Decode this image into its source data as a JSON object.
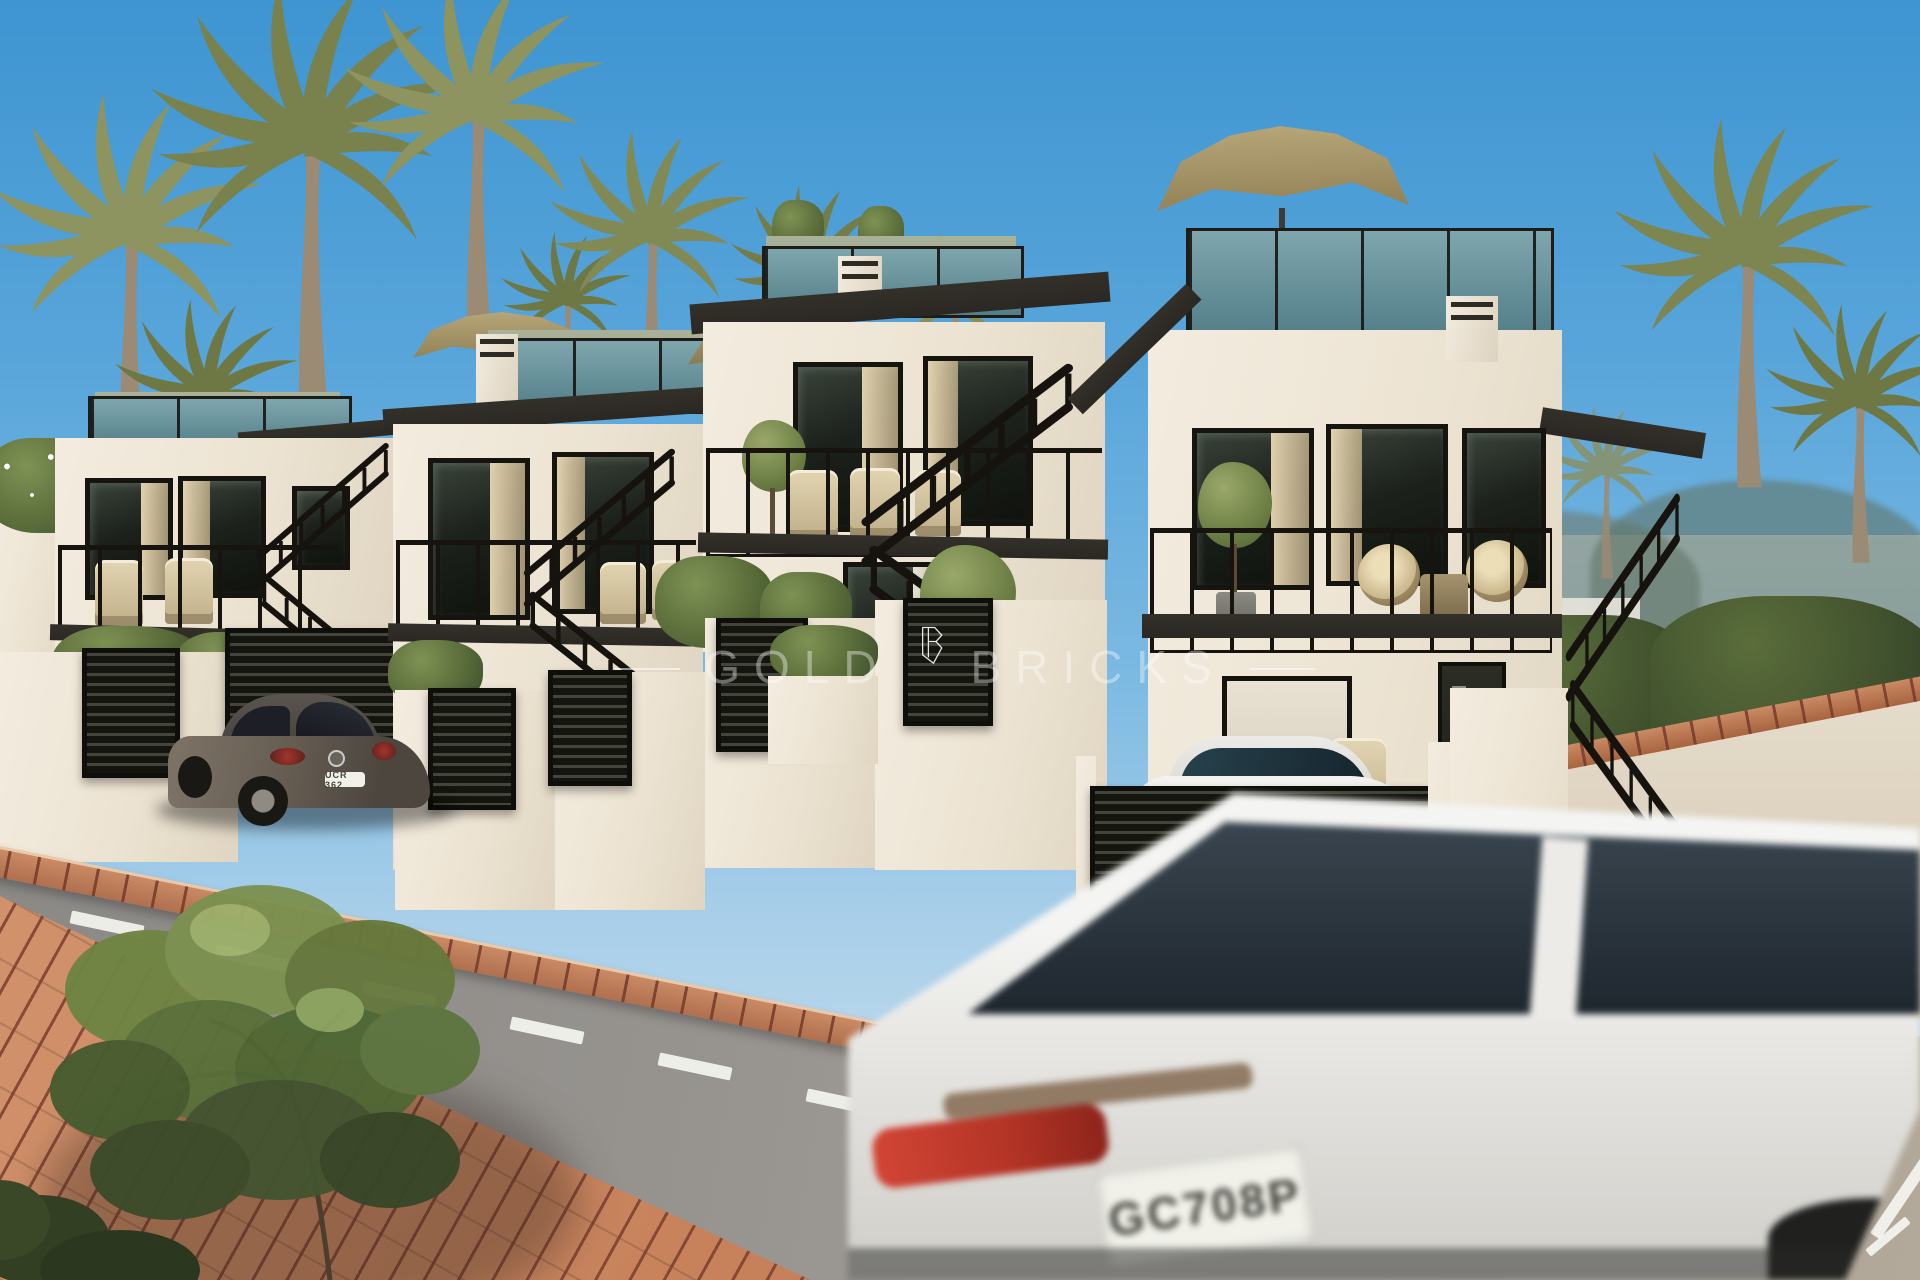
{
  "scene": {
    "kind": "new-build townhouse development render",
    "houses_visible": 4,
    "vehicles_visible": 3
  },
  "watermark": {
    "brand_left": "GOLD",
    "brand_right": "BRICKS",
    "logo": "gold-bricks-crest-icon",
    "color": "#FFFFFF"
  },
  "vehicles": {
    "beetle": {
      "plate": "UCR 362",
      "body_color": "#6b6258"
    },
    "suv": {
      "plate": "GC708P",
      "body_color": "#ebebe8"
    },
    "parked_car": {
      "body_color": "#f2f1ee"
    }
  },
  "palette": {
    "sky_top": "#3e95d1",
    "sky_mid": "#a9cfe9",
    "sky_horizon": "#d3e5f1",
    "wall_light": "#f3ecdf",
    "wall_shade": "#e0d5c2",
    "fascia": "#2b2823",
    "glass_teal": "#527e88",
    "terrace_wall": "#96a184",
    "street_light": "#b3a99a",
    "street_dark": "#898784",
    "brick": "#c57f58",
    "brick_joint": "#7a3e2d",
    "umbrella": "#8d7d52",
    "foliage": "#5d7338",
    "railing": "#17140f",
    "taillight": "#b23325"
  }
}
